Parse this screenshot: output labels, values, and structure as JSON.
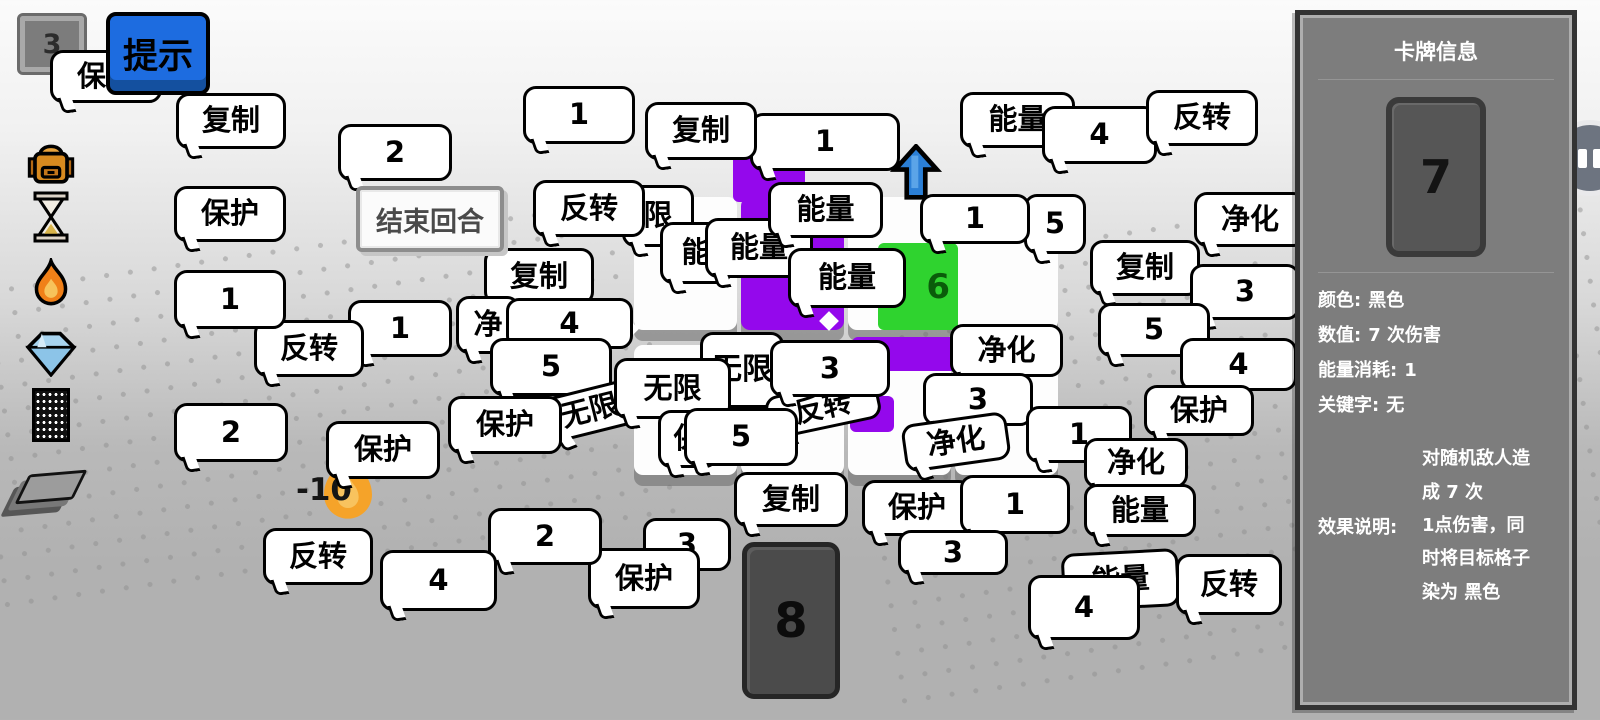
{
  "hud": {
    "counter": "3",
    "hint_button": "提示",
    "end_turn_button": "结束回合",
    "damage_float": "-10",
    "sidebar_icons": [
      "backpack-icon",
      "hourglass-icon",
      "fire-icon",
      "diamond-icon",
      "noise-card-icon",
      "deck-icon"
    ]
  },
  "hand": {
    "card_value": "8"
  },
  "board": {
    "tiles": [
      {
        "x": 634,
        "y": 197,
        "w": 103,
        "h": 133,
        "color": "#fdfdfd"
      },
      {
        "x": 741,
        "y": 197,
        "w": 103,
        "h": 133,
        "color": "#9408ec"
      },
      {
        "x": 848,
        "y": 197,
        "w": 103,
        "h": 133,
        "color": "#fdfdfd"
      },
      {
        "x": 955,
        "y": 197,
        "w": 103,
        "h": 133,
        "color": "#fdfdfd"
      },
      {
        "x": 634,
        "y": 345,
        "w": 103,
        "h": 130,
        "color": "#fdfdfd"
      },
      {
        "x": 741,
        "y": 345,
        "w": 103,
        "h": 130,
        "color": "#fdfdfd"
      },
      {
        "x": 848,
        "y": 345,
        "w": 103,
        "h": 130,
        "color": "#fdfdfd"
      },
      {
        "x": 955,
        "y": 345,
        "w": 103,
        "h": 130,
        "color": "#fdfdfd"
      }
    ],
    "pieces": [
      {
        "x": 733,
        "y": 120,
        "w": 72,
        "h": 82,
        "color": "#9408ec",
        "label": ""
      },
      {
        "x": 878,
        "y": 243,
        "w": 80,
        "h": 87,
        "color": "#2fd32f",
        "label": "6",
        "label_color": "#0a5c0a"
      },
      {
        "x": 852,
        "y": 337,
        "w": 106,
        "h": 34,
        "color": "#9408ec",
        "label": ""
      },
      {
        "x": 850,
        "y": 396,
        "w": 44,
        "h": 36,
        "color": "#9408ec",
        "label": ""
      }
    ],
    "arrow_color": "#2b7fd6"
  },
  "bubbles": [
    {
      "t": "限",
      "x": 622,
      "y": 185,
      "w": 72,
      "h": 62
    },
    {
      "t": "能",
      "x": 660,
      "y": 222,
      "w": 72,
      "h": 62
    },
    {
      "t": "能量",
      "x": 705,
      "y": 218,
      "w": 108,
      "h": 60
    },
    {
      "t": "能量",
      "x": 768,
      "y": 182,
      "w": 115,
      "h": 56
    },
    {
      "t": "1",
      "x": 750,
      "y": 113,
      "w": 150,
      "h": 58
    },
    {
      "t": "复制",
      "x": 645,
      "y": 102,
      "w": 112,
      "h": 58
    },
    {
      "t": "1",
      "x": 523,
      "y": 86,
      "w": 112,
      "h": 58
    },
    {
      "t": "反转",
      "x": 533,
      "y": 180,
      "w": 112,
      "h": 57
    },
    {
      "t": "能量",
      "x": 788,
      "y": 248,
      "w": 118,
      "h": 60
    },
    {
      "t": "5",
      "x": 1024,
      "y": 194,
      "w": 62,
      "h": 60
    },
    {
      "t": "1",
      "x": 920,
      "y": 194,
      "w": 110,
      "h": 50
    },
    {
      "t": "能量",
      "x": 960,
      "y": 92,
      "w": 115,
      "h": 56
    },
    {
      "t": "4",
      "x": 1042,
      "y": 106,
      "w": 115,
      "h": 58
    },
    {
      "t": "反转",
      "x": 1146,
      "y": 90,
      "w": 112,
      "h": 56
    },
    {
      "t": "净化",
      "x": 1194,
      "y": 192,
      "w": 112,
      "h": 55
    },
    {
      "t": "复制",
      "x": 1090,
      "y": 240,
      "w": 110,
      "h": 56
    },
    {
      "t": "3",
      "x": 1190,
      "y": 264,
      "w": 110,
      "h": 56
    },
    {
      "t": "5",
      "x": 1098,
      "y": 303,
      "w": 112,
      "h": 54
    },
    {
      "t": "4",
      "x": 1180,
      "y": 338,
      "w": 117,
      "h": 53
    },
    {
      "t": "保护",
      "x": 1144,
      "y": 385,
      "w": 110,
      "h": 51
    },
    {
      "t": "净化",
      "x": 950,
      "y": 324,
      "w": 113,
      "h": 53
    },
    {
      "t": "3",
      "x": 923,
      "y": 373,
      "w": 110,
      "h": 53
    },
    {
      "t": "净化",
      "x": 903,
      "y": 418,
      "w": 106,
      "h": 48,
      "rot": -8
    },
    {
      "t": "1",
      "x": 1026,
      "y": 406,
      "w": 106,
      "h": 57
    },
    {
      "t": "净化",
      "x": 1084,
      "y": 438,
      "w": 104,
      "h": 50
    },
    {
      "t": "能量",
      "x": 1084,
      "y": 484,
      "w": 112,
      "h": 53
    },
    {
      "t": "复制",
      "x": 484,
      "y": 248,
      "w": 110,
      "h": 57
    },
    {
      "t": "净",
      "x": 456,
      "y": 296,
      "w": 64,
      "h": 58
    },
    {
      "t": "4",
      "x": 506,
      "y": 298,
      "w": 127,
      "h": 51
    },
    {
      "t": "5",
      "x": 490,
      "y": 338,
      "w": 122,
      "h": 58
    },
    {
      "t": "无限",
      "x": 543,
      "y": 388,
      "w": 94,
      "h": 46,
      "rot": -14
    },
    {
      "t": "保护",
      "x": 448,
      "y": 396,
      "w": 114,
      "h": 58
    },
    {
      "t": "无限",
      "x": 700,
      "y": 332,
      "w": 84,
      "h": 76,
      "fs": 30
    },
    {
      "t": "无限",
      "x": 614,
      "y": 358,
      "w": 117,
      "h": 61
    },
    {
      "t": "反转",
      "x": 766,
      "y": 386,
      "w": 114,
      "h": 43,
      "rot": -12
    },
    {
      "t": "3",
      "x": 770,
      "y": 340,
      "w": 120,
      "h": 57
    },
    {
      "t": "保",
      "x": 658,
      "y": 410,
      "w": 60,
      "h": 58
    },
    {
      "t": "5",
      "x": 684,
      "y": 408,
      "w": 114,
      "h": 58
    },
    {
      "t": "保护",
      "x": 326,
      "y": 421,
      "w": 114,
      "h": 58
    },
    {
      "t": "1",
      "x": 348,
      "y": 300,
      "w": 104,
      "h": 57
    },
    {
      "t": "反转",
      "x": 254,
      "y": 320,
      "w": 110,
      "h": 57
    },
    {
      "t": "1",
      "x": 174,
      "y": 270,
      "w": 112,
      "h": 59
    },
    {
      "t": "2",
      "x": 174,
      "y": 403,
      "w": 114,
      "h": 59
    },
    {
      "t": "保护",
      "x": 174,
      "y": 186,
      "w": 112,
      "h": 56
    },
    {
      "t": "复制",
      "x": 176,
      "y": 93,
      "w": 110,
      "h": 56
    },
    {
      "t": "保护",
      "x": 50,
      "y": 50,
      "w": 112,
      "h": 53
    },
    {
      "t": "2",
      "x": 338,
      "y": 124,
      "w": 114,
      "h": 57
    },
    {
      "t": "复制",
      "x": 734,
      "y": 472,
      "w": 114,
      "h": 55
    },
    {
      "t": "保护",
      "x": 862,
      "y": 480,
      "w": 110,
      "h": 56
    },
    {
      "t": "1",
      "x": 960,
      "y": 475,
      "w": 110,
      "h": 59
    },
    {
      "t": "3",
      "x": 898,
      "y": 530,
      "w": 110,
      "h": 45
    },
    {
      "t": "能量",
      "x": 1062,
      "y": 551,
      "w": 117,
      "h": 58,
      "rot": -3
    },
    {
      "t": "4",
      "x": 1028,
      "y": 575,
      "w": 112,
      "h": 65
    },
    {
      "t": "反转",
      "x": 1176,
      "y": 554,
      "w": 106,
      "h": 61
    },
    {
      "t": "3",
      "x": 643,
      "y": 518,
      "w": 88,
      "h": 53
    },
    {
      "t": "保护",
      "x": 588,
      "y": 548,
      "w": 112,
      "h": 61
    },
    {
      "t": "2",
      "x": 488,
      "y": 508,
      "w": 114,
      "h": 57
    },
    {
      "t": "4",
      "x": 380,
      "y": 550,
      "w": 117,
      "h": 61
    },
    {
      "t": "反转",
      "x": 263,
      "y": 528,
      "w": 110,
      "h": 57
    }
  ],
  "panel": {
    "title": "卡牌信息",
    "card_value": "7",
    "fields": [
      {
        "label": "颜色:",
        "value": "黑色"
      },
      {
        "label": "数值:",
        "value": "7 次伤害"
      },
      {
        "label": "能量消耗:",
        "value": "1"
      },
      {
        "label": "关键字:",
        "value": "无"
      }
    ],
    "effect_label": "效果说明:",
    "effect_value": "对随机敌人造\n成 7 次\n1点伤害，同\n时将目标格子\n染为 黑色"
  },
  "colors": {
    "accent_blue": "#1d6ce0",
    "tile_purple": "#9408ec",
    "tile_green": "#2fd32f",
    "arrow_blue": "#2b7fd6",
    "flame_orange": "#f5a329",
    "panel_gray": "#7d7d7d"
  }
}
